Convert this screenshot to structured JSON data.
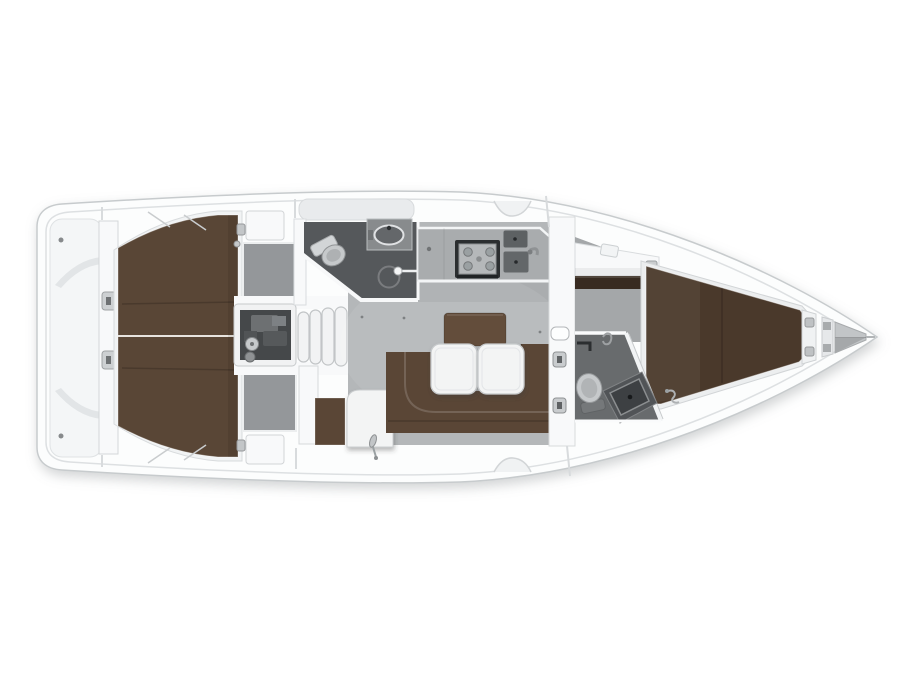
{
  "figure": {
    "type": "yacht-deck-plan",
    "orientation": "bow-right",
    "text_visible": ""
  },
  "colors": {
    "background": "#ffffff",
    "hull": "#fcfdfd",
    "hull_outline": "#c7cbcd",
    "rim": "#dde0e2",
    "deck_panel": "#f4f6f7",
    "wall": "#f8f9fa",
    "fixture_white": "#f2f3f4",
    "fixture_gray": "#c7cacc",
    "metal": "#9ea1a3",
    "panel_gray": "#94979a",
    "saloon_floor": "#b4b7b9",
    "cabin_floor": "#a4a7a9",
    "counter": "#a9acae",
    "head_floor_aft": "#55585b",
    "head_floor_fwd": "#686b6d",
    "berth_aft": "#594636",
    "berth_fwd": "#4a392b",
    "sofa": "#5a4636",
    "backrest": "#634d3b",
    "wood_trim": "#382b21",
    "table": "#f3f4f4",
    "stove_frame": "#2b2e30",
    "stove_top": "#b5b8ba",
    "sink": "#5d6163",
    "engine_bay": "#45484a",
    "machinery": "#6d7072",
    "toilet": "#c6c9cb",
    "seam_line": "#e8e4df",
    "shadow": "#8d9194"
  },
  "rooms": [
    {
      "id": "stern-platform",
      "name": "transom-and-swim-platform"
    },
    {
      "id": "aft-cabin",
      "name": "aft-double-berth-cabin"
    },
    {
      "id": "engine-compartment",
      "name": "engine-compartment"
    },
    {
      "id": "companionway",
      "name": "companionway-steps"
    },
    {
      "id": "aft-head",
      "name": "aft-head-wc-shower"
    },
    {
      "id": "galley",
      "name": "galley-stove-double-sink"
    },
    {
      "id": "saloon",
      "name": "saloon-u-sofa-twin-tables"
    },
    {
      "id": "nav-station",
      "name": "chart-table-corner"
    },
    {
      "id": "fwd-head",
      "name": "forward-head-wc-shower"
    },
    {
      "id": "fwd-cabin",
      "name": "forward-v-berth-cabin"
    },
    {
      "id": "anchor-locker",
      "name": "bow-anchor-locker"
    }
  ]
}
